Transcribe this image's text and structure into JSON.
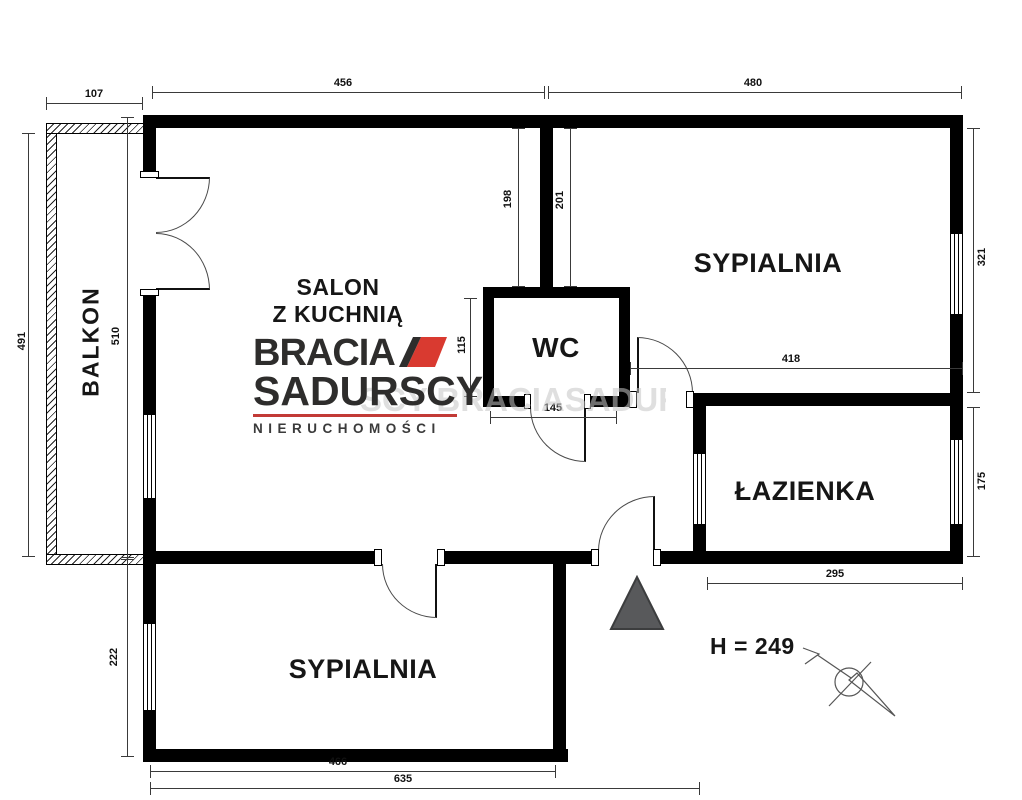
{
  "plan": {
    "balcony_label": "BALKON",
    "salon_label_line1": "SALON",
    "salon_label_line2": "Z KUCHNIĄ",
    "bedroom_top_label": "SYPIALNIA",
    "bedroom_bottom_label": "SYPIALNIA",
    "wc_label": "WC",
    "bathroom_label": "ŁAZIENKA",
    "height_note": "H = 249",
    "watermark_text": "SCY BRACIASADURSC",
    "dims": {
      "balcony_width": "107",
      "salon_top": "456",
      "bedroom_top": "480",
      "balcony_outer_height": "491",
      "balcony_inner_height": "510",
      "bedroom_left_height": "222",
      "partition_salon_side": "198",
      "partition_bedroom_side": "201",
      "wc_height": "115",
      "wc_width": "145",
      "bedroom_right_height": "321",
      "bedroom_width": "418",
      "bathroom_height": "175",
      "bathroom_width": "295",
      "bedroom_bottom_width": "466",
      "total_bottom_width": "635"
    }
  },
  "logo": {
    "brand_line1": "BRACIA",
    "brand_line2": "SADURSCY",
    "tagline": "NIERUCHOMOŚCI"
  },
  "colors": {
    "wall": "#000000",
    "logo_text": "#2e2d2c",
    "logo_accent": "#d93a30",
    "entrance_marker": "#58595b"
  }
}
